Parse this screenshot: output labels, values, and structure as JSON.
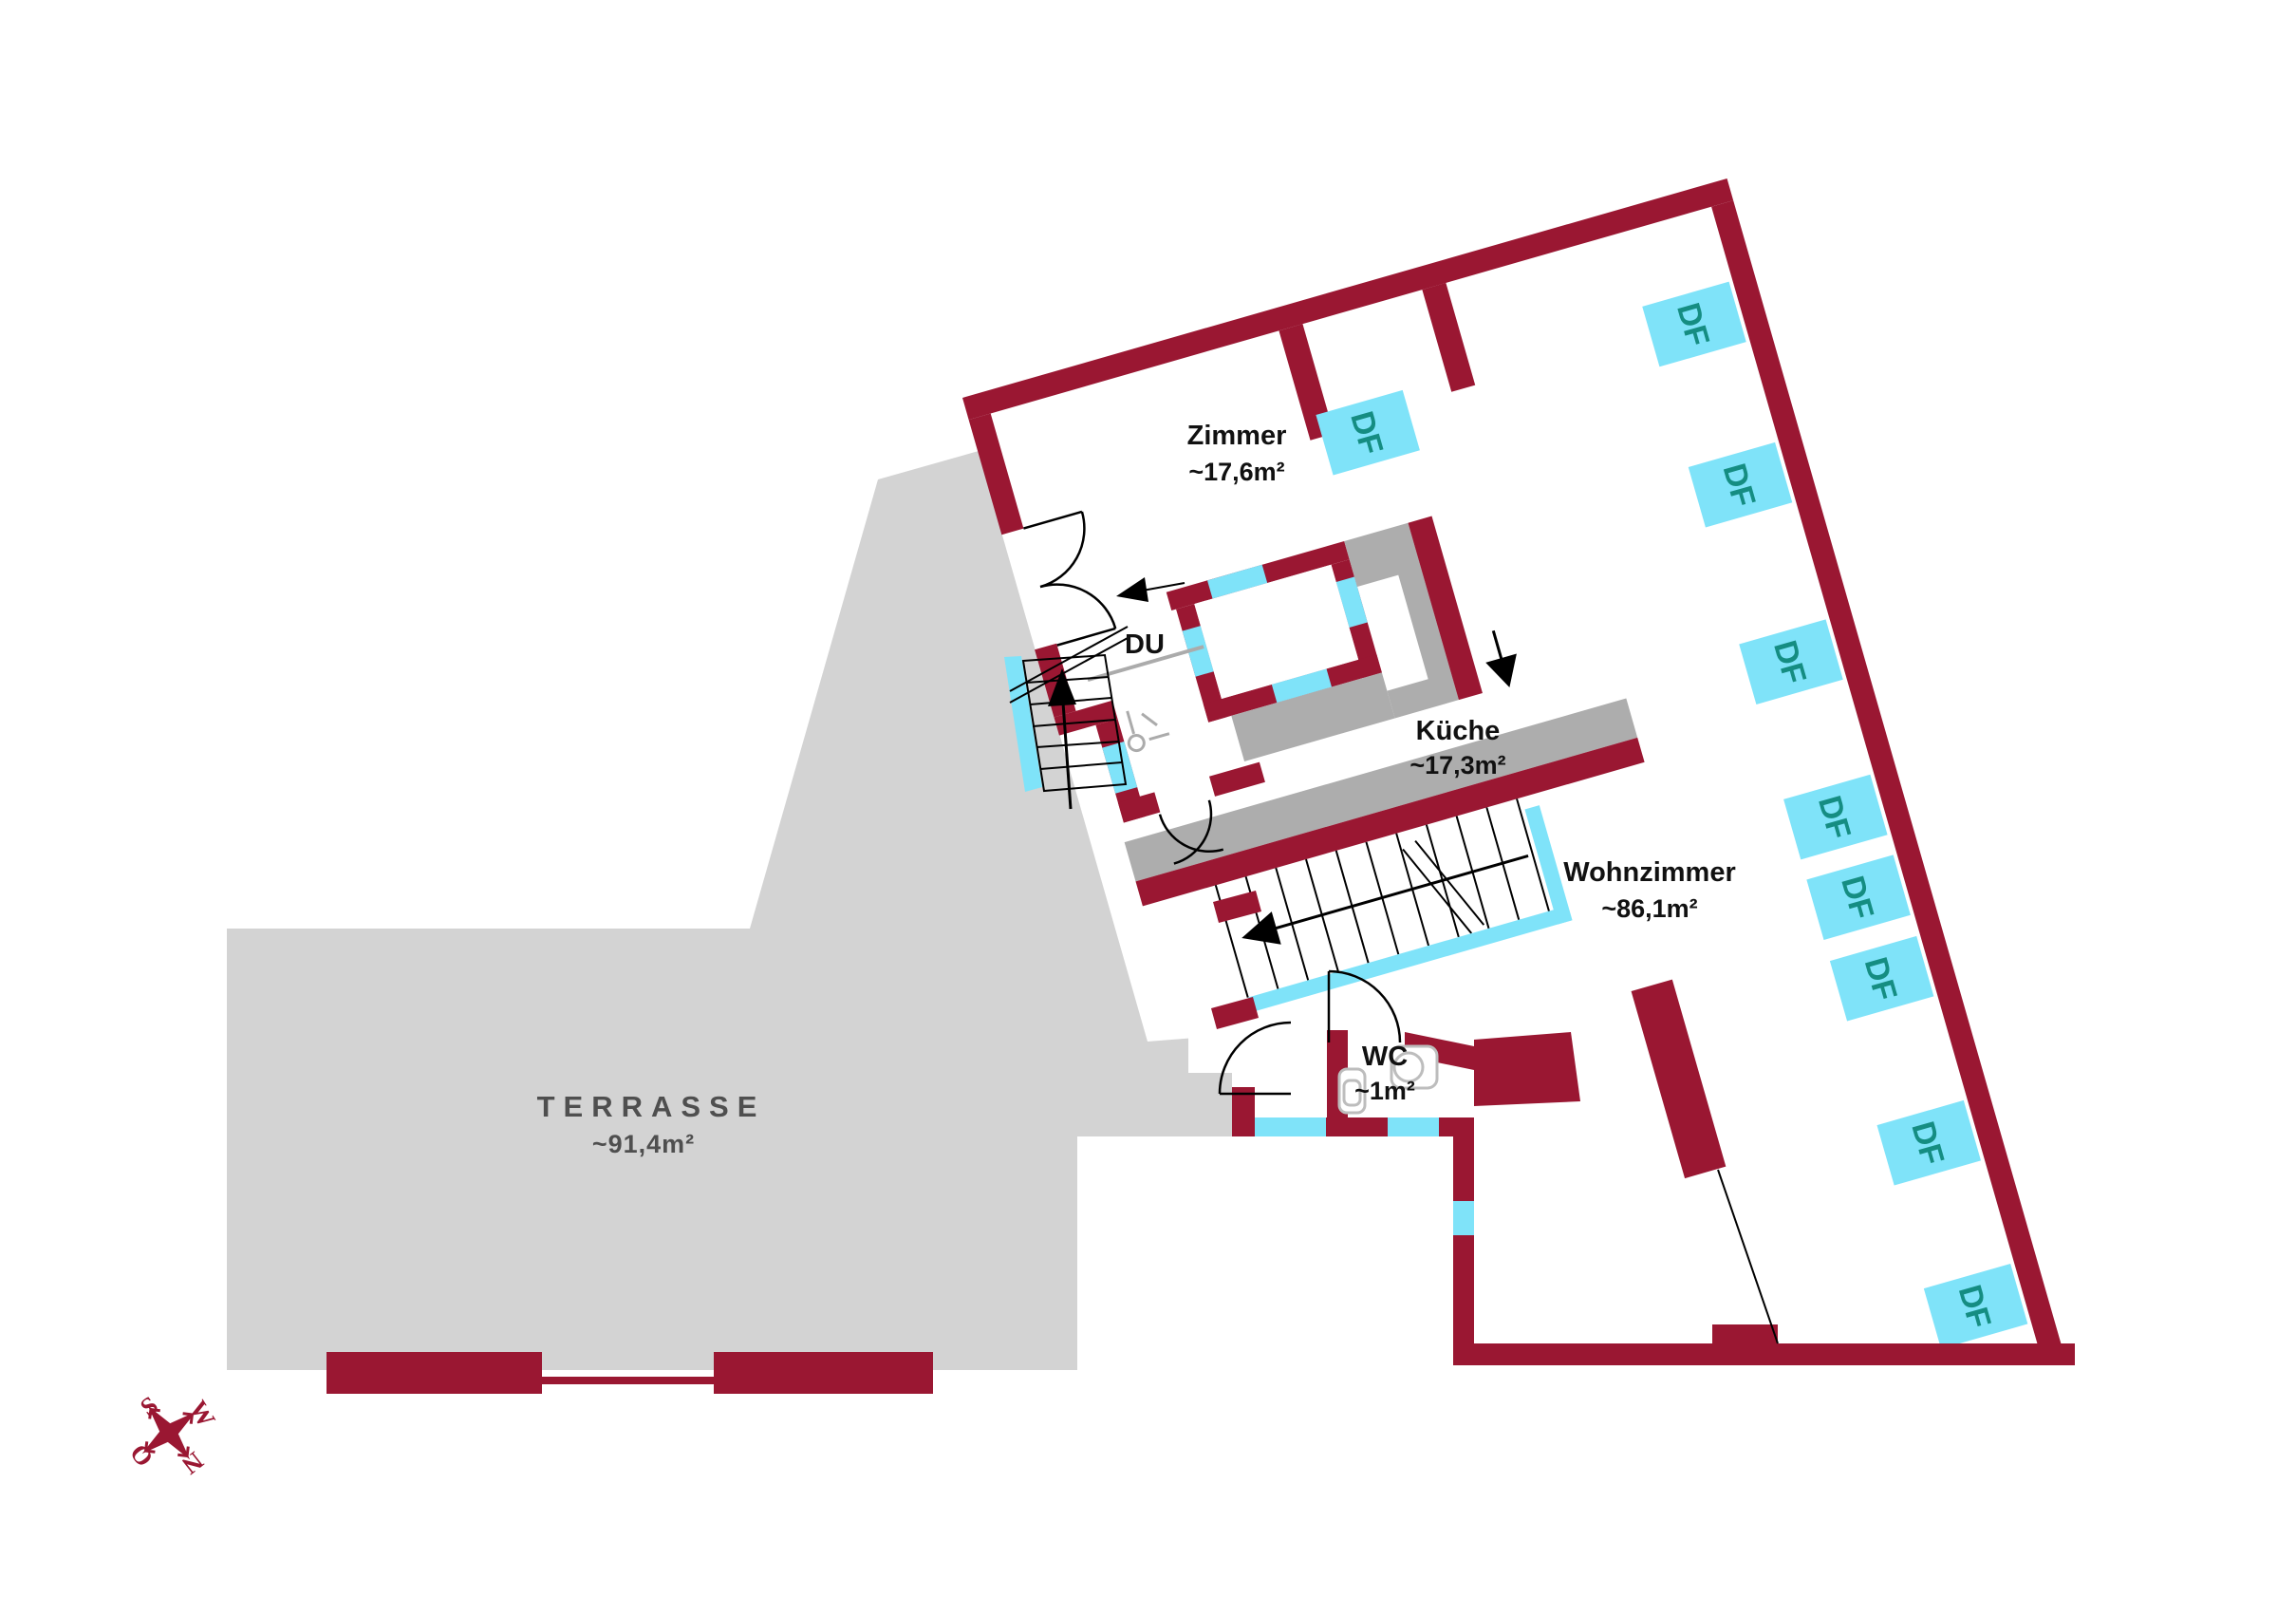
{
  "rooms": {
    "zimmer": {
      "name": "Zimmer",
      "area": "~17,6m²"
    },
    "kueche": {
      "name": "Küche",
      "area": "~17,3m²"
    },
    "wohnzimmer": {
      "name": "Wohnzimmer",
      "area": "~86,1m²"
    },
    "dusche": {
      "name": "DU"
    },
    "wc": {
      "name": "WC",
      "area": "~1m²"
    },
    "terrasse": {
      "name": "TERRASSE",
      "area": "~91,4m²"
    }
  },
  "skylight": {
    "label": "DF",
    "count": 9
  },
  "compass": {
    "north": "N",
    "east": "O",
    "south": "S",
    "west": "W"
  },
  "colors": {
    "wall": "#9A1732",
    "window": "#7FE3F9",
    "window-text": "#158D82",
    "terrace": "#D3D3D3",
    "counter": "#ADADAD",
    "fixture": "#BDBDBD",
    "partition": "#ABABAB",
    "line": "#000000",
    "label": "#111111",
    "terrace-text": "#4F4F4F"
  }
}
